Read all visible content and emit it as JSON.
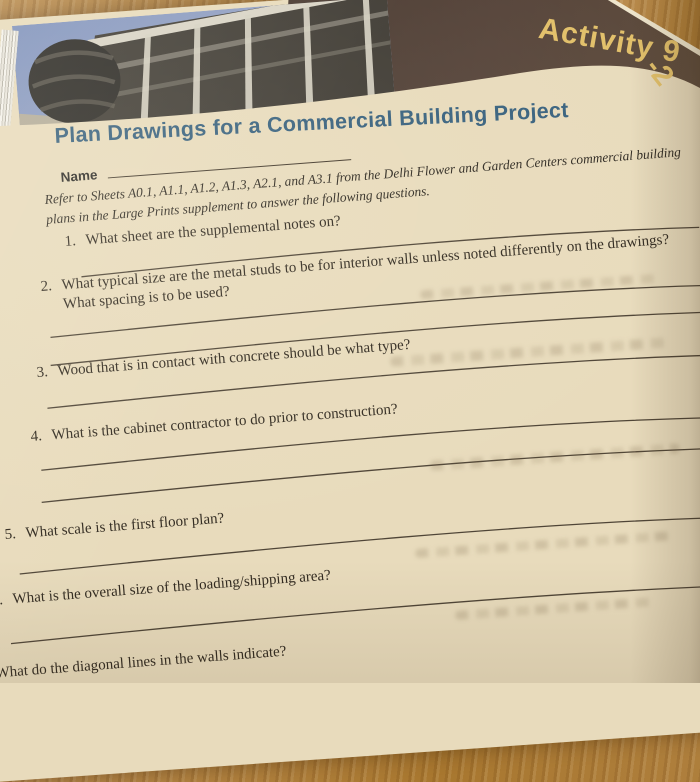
{
  "banner": {
    "label": "Activity 9-2",
    "label_main": "Activity 9",
    "label_tail": "-2"
  },
  "page": {
    "title": "Plan Drawings for a Commercial Building Project"
  },
  "photo": {
    "alt": "corner of a modern commercial building against a blue sky"
  },
  "name_field": {
    "label": "Name"
  },
  "instructions": {
    "line1": "Refer to Sheets A0.1, A1.1, A1.2, A1.3, A2.1, and A3.1 from the Delhi Flower and Garden Centers commercial building",
    "line2": "plans in the Large Prints supplement to answer the following questions."
  },
  "questions": [
    {
      "number": "1.",
      "text": "What sheet are the supplemental notes on?",
      "answer_lines": 1
    },
    {
      "number": "2.",
      "text": "What typical size are the metal studs to be for interior walls unless noted differently on the drawings?",
      "text2": "What spacing is to be used?",
      "answer_lines": 2
    },
    {
      "number": "3.",
      "text": "Wood that is in contact with concrete should be what type?",
      "answer_lines": 1
    },
    {
      "number": "4.",
      "text": "What is the cabinet contractor to do prior to construction?",
      "answer_lines": 2
    },
    {
      "number": "5.",
      "text": "What scale is the first floor plan?",
      "answer_lines": 1
    },
    {
      "number": "6.",
      "text": "What is the overall size of the loading/shipping area?",
      "answer_lines": 1
    },
    {
      "number": "7.",
      "text": "What do the diagonal lines in the walls indicate?",
      "answer_lines": 0
    }
  ],
  "colors": {
    "table_wood": "#ad7c38",
    "page": "#e8dbbc",
    "banner_bg": "#55433a",
    "banner_text": "#e2c06a",
    "title": "#38617e",
    "body_text": "#322b21",
    "rule_lines": "#4f4537",
    "photo_sky": "#8496c0"
  }
}
